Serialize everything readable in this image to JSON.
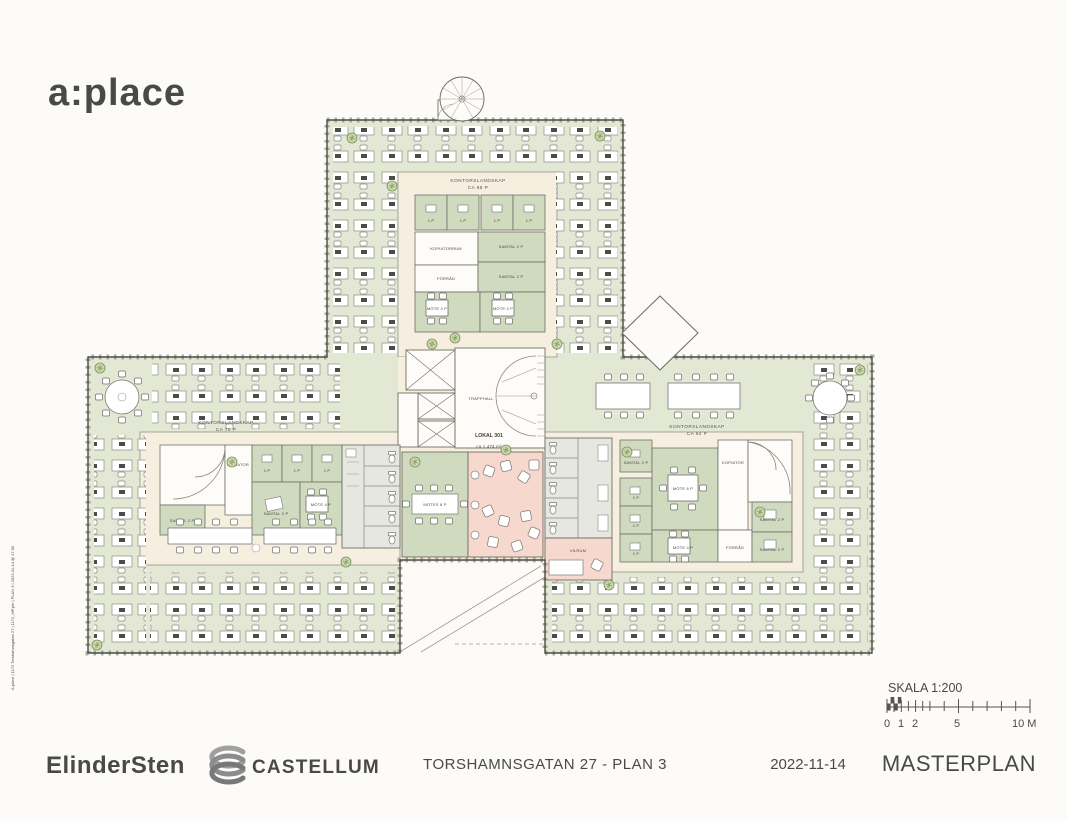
{
  "header": {
    "logo": "a:place"
  },
  "plot_stamp": "A:place | 1172 Torshamnsgatan 27 | 1172_MP.pln | PLAN 3 | 2022-11-14 @ 17:05",
  "plan": {
    "wings": {
      "top": {
        "label": "KONTORSLANDSKAP",
        "capacity": "CA 66 P"
      },
      "left": {
        "label": "KONTORSLANDSKAP",
        "capacity": "CA 70 P"
      },
      "right": {
        "label": "KONTORSLANDSKAP",
        "capacity": "CA 62 P"
      }
    },
    "local": {
      "name": "LOKAL 301",
      "area": "ca 1 474 m²"
    },
    "rooms": {
      "trapphall": "TRAPPHALL",
      "kopiatorrum": "KOPIATORRUM",
      "kopiator": "KOPIATOR",
      "forrad": "FÖRRÅD",
      "samtal2": "SAMTAL 2 P",
      "mote4": "MÖTE 4 P",
      "mote6": "MÖTE 6 P",
      "mote8": "MÖTES 8 P",
      "vilrum": "VILRUM",
      "onep": "1 P"
    },
    "colors": {
      "open_office": "#e3e8d4",
      "meeting_room": "#cfdabe",
      "circulation": "#f6efe0",
      "lounge_pink": "#f6d8cf",
      "wc_gray": "#e7e7e2",
      "wall": "#4c4c45"
    }
  },
  "scale_bar": {
    "label": "SKALA 1:200",
    "tick_labels": [
      "0",
      "1",
      "2",
      "5",
      "10 M"
    ]
  },
  "footer": {
    "architect_logo": "ElinderSten",
    "client_logo": "CASTELLUM",
    "project_title": "TORSHAMNSGATAN 27 - PLAN 3",
    "date": "2022-11-14",
    "doc_type": "MASTERPLAN"
  }
}
